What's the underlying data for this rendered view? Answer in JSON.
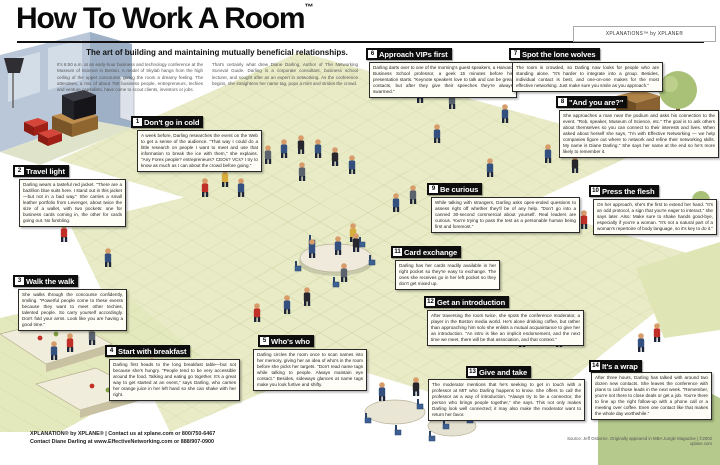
{
  "header": {
    "title": "How To Work A Room",
    "trademark": "™",
    "brand_badge": "XPLANATiONS™ by XPLANE®",
    "subtitle": "The art of building and maintaining mutually beneficial relationships.",
    "intro_col1": "It's 6:50 a.m. at an early-hour business and technology conference at the Museum of Science in Boston. A model of Skylab hangs from the high ceiling of the upper concourse, giving the room a dreamy feeling. The attendees, a mix of about 750 business people, entrepreneurs, techies and venture capitalists, have come to scout clients, investors or jobs.",
    "intro_col2": "That's certainly what drew Diane Darling, Author of The Networking Survival Guide. Darling is a corporate consultant, business school lecturer, and sought after as an expert in networking. As the conference begins, she straightens her name tag, pops a mint and strides the crowd."
  },
  "sections": [
    {
      "id": "dont-go-in-cold",
      "num": "1",
      "title": "Don't go in cold",
      "body": "A week before, Darling researches the event on the Web to get a sense of the audience. \"That way I could do a little research on people I want to meet and use that information to break the ice with them,\" she explains. \"Any Forex people? entrepreneurs? CEOs? VCs? I try to know as much as I can about the crowd before going.\""
    },
    {
      "id": "travel-light",
      "num": "2",
      "title": "Travel light",
      "body": "Darling wears a tasteful red jacket. \"There are a bazillion blue suits here. I stand out in this jacket—but not in a bad way.\" She carries a small leather portfolio from Levenger, about twice the size of a wallet, with two pockets: one for business cards coming in, the other for cards going out. No fumbling."
    },
    {
      "id": "walk-the-walk",
      "num": "3",
      "title": "Walk the walk",
      "body": "She walks through the concourse confidently, smiling. \"Powerful people come to these events because they want to meet other techies, talented people. So carry yourself accordingly. Don't fold your arms. Look like you are having a good time.\""
    },
    {
      "id": "start-with-breakfast",
      "num": "4",
      "title": "Start with breakfast",
      "body": "Darling first heads to the long breakfast table—but not because she's hungry. \"People tend to be very accessible around the food. Talking and eating go together. It's a great way to get started at an event,\" says Darling, who carries her orange juice in her left hand so she can shake with her right."
    },
    {
      "id": "whos-who",
      "num": "5",
      "title": "Who's who",
      "body": "Darling circles the room once to scan names into her memory, giving her an idea of who's in the room before she picks her targets. \"Don't read name tags while talking to people. Always maintain eye contact.\" Besides, sideways glances at name tags make you look furtive and shifty."
    },
    {
      "id": "approach-vips-first",
      "num": "6",
      "title": "Approach VIPs first",
      "body": "Darling darts over to one of the morning's guest speakers, a Harvard Business School professor, a geek 15 minutes before his presentation starts. \"Keynote speakers love to talk and can be great contacts, but after they give their speeches they're always swarmed.\""
    },
    {
      "id": "spot-the-lone-wolves",
      "num": "7",
      "title": "Spot the lone wolves",
      "body": "The room is crowded, so Darling now looks for people who are standing alone. \"It's harder to integrate into a group. Besides, individual contact is best, and one-on-one makes for the most effective networking. Just make sure you smile as you approach.\""
    },
    {
      "id": "and-you-are",
      "num": "8",
      "title": "\"And you are?\"",
      "body": "She approaches a man near the podium and asks his connection to the event. \"Rob, speaker, Museum of Science, etc.\" The goal is to ask others about themselves so you can connect to their interests and lives. When asked about herself she says, \"I'm with Effective Networking — we help companies figure out where to network and refine their networking skills. My name is Diane Darling.\" She says her name at the end so he's more likely to remember it."
    },
    {
      "id": "be-curious",
      "num": "9",
      "title": "Be curious",
      "body": "While talking with strangers, Darling asks open-ended questions to assess right off whether they'll be of any help. \"Don't go into a canned 30-second commercial about yourself. Real leaders are curious. You're trying to pass the test as a personable human being first and foremost.\""
    },
    {
      "id": "press-the-flesh",
      "num": "10",
      "title": "Press the flesh",
      "body": "On her approach, she's the first to extend her hand. \"It's an odd protocol, a sign that you're eager to interact,\" she says later. Also: Make sure to shake hands good-bye, especially if you're a woman. \"It's not a natural part of a woman's repertoire of body language, so it's key to do it.\""
    },
    {
      "id": "card-exchange",
      "num": "11",
      "title": "Card exchange",
      "body": "Darling has her cards readily available in her right pocket so they're easy to exchange. The ones she receives go in her left pocket so they don't get mixed up."
    },
    {
      "id": "get-an-introduction",
      "num": "12",
      "title": "Get an introduction",
      "body": "After traversing the room twice, she spots the conference moderator, a player in the Boston media world. He's alone drinking coffee, but rather than approaching him solo she enlists a mutual acquaintance to give her an introduction. \"An intro is like an implicit endorsement, and the next time we meet, there will be that association, and that context.\""
    },
    {
      "id": "give-and-take",
      "num": "13",
      "title": "Give and take",
      "body": "The moderator mentions that he's seeking to get in touch with a professor at MIT who Darling happens to know. She offers to call the professor as a way of introduction. \"Always try to be a connector, the person who brings people together,\" she says. This not only makes Darling look well connected; it may also make the moderator want to return her favor."
    },
    {
      "id": "its-a-wrap",
      "num": "14",
      "title": "It's a wrap",
      "body": "After three hours, Darling has talked with around two dozen new contacts. She leaves the conference with plans to call those leads in the next week. \"Remember, you're not there to close deals or get a job. You're there to line up the right follow-up with a phone call or a meeting over coffee. Even one contact like that makes the whole day worthwhile.\""
    }
  ],
  "footer": {
    "left_line1": "XPLANATION® by XPLANE® | Contact us at xplane.com or 800/750-6467",
    "left_line2": "Contact Diane Darling at www.EffectiveNetworking.com or 888/907-0900",
    "source": "Source: Jeff Osborne. Originally appeared in MBA Jungle Magazine | ©2002 xplane.com"
  },
  "colors": {
    "floor": "#e8ebc6",
    "floor_line": "#ccd39e",
    "floor_green": "#b5c98c",
    "header_bar": "#0d0d0d",
    "accent_red": "#bf2f27",
    "suit_navy": "#33507e",
    "wall_blue": "#b9c7d8"
  }
}
